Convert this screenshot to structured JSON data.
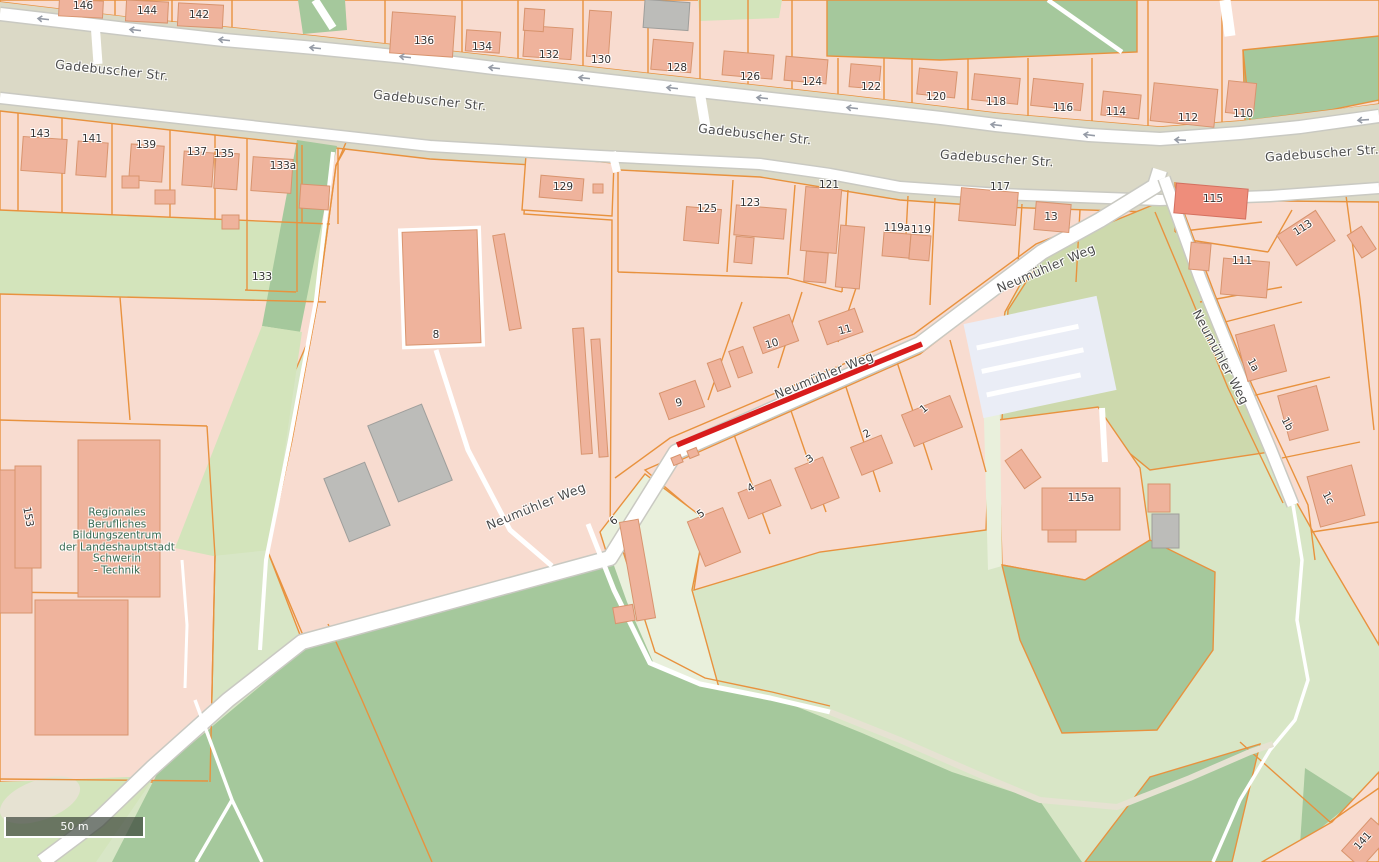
{
  "map": {
    "scale_bar": {
      "text": "50 m"
    },
    "colors": {
      "residential_pink": "#f8dcd0",
      "building_salmon": "#efb39c",
      "building_outline": "#d8946e",
      "building_highlight": "#ee8d7b",
      "building_grey": "#bcbcb9",
      "parcel_orange": "#e8923e",
      "road_yellow": "#f8e87c",
      "road_yellow_casing": "#d8c96e",
      "road_white": "#ffffff",
      "road_casing": "#c9c9c2",
      "road_area_tan": "#dbd9c6",
      "industrial_grey": "#e4e4e1",
      "parking_grey": "#eaedf6",
      "forest_green": "#a5c89c",
      "grass_green": "#d3e4bb",
      "meadow_green": "#d8e6c6",
      "pale_green": "#e9f0dc",
      "scrub_olive": "#cdd9ad",
      "path_beige": "#e6e2d2",
      "highlight_red": "#d81c1c",
      "arrow_grey": "#959ba6",
      "street_label": "#4c4c4c",
      "number_label": "#333333",
      "school_label": "#356b53",
      "scalebar_bg": "rgba(55,65,55,0.68)",
      "scalebar_text": "#ffffff"
    },
    "street_labels": [
      {
        "text": "Gadebuscher Str.",
        "x": 112,
        "y": 70,
        "rot": 6
      },
      {
        "text": "Gadebuscher Str.",
        "x": 430,
        "y": 100,
        "rot": 6
      },
      {
        "text": "Gadebuscher Str.",
        "x": 755,
        "y": 134,
        "rot": 6
      },
      {
        "text": "Gadebuscher Str.",
        "x": 997,
        "y": 158,
        "rot": 4
      },
      {
        "text": "Gadebuscher Str.",
        "x": 1322,
        "y": 153,
        "rot": -4
      },
      {
        "text": "Neumühler Weg",
        "x": 824,
        "y": 375,
        "rot": -22
      },
      {
        "text": "Neumühler Weg",
        "x": 1046,
        "y": 268,
        "rot": -23
      },
      {
        "text": "Neumühler Weg",
        "x": 1221,
        "y": 357,
        "rot": 62
      },
      {
        "text": "Neumühler Weg",
        "x": 536,
        "y": 506,
        "rot": -22
      }
    ],
    "house_numbers": [
      {
        "text": "146",
        "x": 83,
        "y": 6
      },
      {
        "text": "144",
        "x": 147,
        "y": 11
      },
      {
        "text": "142",
        "x": 199,
        "y": 15
      },
      {
        "text": "136",
        "x": 424,
        "y": 41
      },
      {
        "text": "134",
        "x": 482,
        "y": 47
      },
      {
        "text": "132",
        "x": 549,
        "y": 55
      },
      {
        "text": "130",
        "x": 601,
        "y": 60
      },
      {
        "text": "128",
        "x": 677,
        "y": 68
      },
      {
        "text": "126",
        "x": 750,
        "y": 77
      },
      {
        "text": "124",
        "x": 812,
        "y": 82
      },
      {
        "text": "122",
        "x": 871,
        "y": 87
      },
      {
        "text": "120",
        "x": 936,
        "y": 97
      },
      {
        "text": "118",
        "x": 996,
        "y": 102
      },
      {
        "text": "116",
        "x": 1063,
        "y": 108
      },
      {
        "text": "114",
        "x": 1116,
        "y": 112
      },
      {
        "text": "112",
        "x": 1188,
        "y": 118
      },
      {
        "text": "110",
        "x": 1243,
        "y": 114
      },
      {
        "text": "143",
        "x": 40,
        "y": 134
      },
      {
        "text": "141",
        "x": 92,
        "y": 139
      },
      {
        "text": "139",
        "x": 146,
        "y": 145
      },
      {
        "text": "137",
        "x": 197,
        "y": 152
      },
      {
        "text": "135",
        "x": 224,
        "y": 154
      },
      {
        "text": "133a",
        "x": 283,
        "y": 166
      },
      {
        "text": "133",
        "x": 262,
        "y": 277
      },
      {
        "text": "129",
        "x": 563,
        "y": 187
      },
      {
        "text": "125",
        "x": 707,
        "y": 209
      },
      {
        "text": "123",
        "x": 750,
        "y": 203
      },
      {
        "text": "121",
        "x": 829,
        "y": 185
      },
      {
        "text": "119a",
        "x": 897,
        "y": 228
      },
      {
        "text": "119",
        "x": 921,
        "y": 230
      },
      {
        "text": "117",
        "x": 1000,
        "y": 187
      },
      {
        "text": "13",
        "x": 1051,
        "y": 217
      },
      {
        "text": "115",
        "x": 1213,
        "y": 199
      },
      {
        "text": "111",
        "x": 1242,
        "y": 261
      },
      {
        "text": "113",
        "x": 1303,
        "y": 228,
        "rot": -33
      },
      {
        "text": "8",
        "x": 436,
        "y": 335
      },
      {
        "text": "10",
        "x": 772,
        "y": 344,
        "rot": -15
      },
      {
        "text": "11",
        "x": 845,
        "y": 330,
        "rot": -15
      },
      {
        "text": "9",
        "x": 679,
        "y": 403,
        "rot": -12
      },
      {
        "text": "1",
        "x": 924,
        "y": 409,
        "rot": -40
      },
      {
        "text": "2",
        "x": 867,
        "y": 434,
        "rot": -30
      },
      {
        "text": "3",
        "x": 810,
        "y": 459,
        "rot": -35
      },
      {
        "text": "4",
        "x": 751,
        "y": 488,
        "rot": -30
      },
      {
        "text": "5",
        "x": 701,
        "y": 514,
        "rot": -35
      },
      {
        "text": "6",
        "x": 614,
        "y": 521,
        "rot": -40
      },
      {
        "text": "115a",
        "x": 1081,
        "y": 498
      },
      {
        "text": "1a",
        "x": 1253,
        "y": 365,
        "rot": 62
      },
      {
        "text": "1b",
        "x": 1287,
        "y": 424,
        "rot": 62
      },
      {
        "text": "1c",
        "x": 1328,
        "y": 498,
        "rot": 62
      },
      {
        "text": "153",
        "x": 28,
        "y": 517,
        "rot": 80
      },
      {
        "text": "141",
        "x": 1363,
        "y": 841,
        "rot": -48
      }
    ],
    "school": {
      "x": 117,
      "y": 542,
      "lines": [
        "Regionales",
        "Berufliches",
        "Bildungszentrum",
        "der Landeshauptstadt",
        "Schwerin",
        "- Technik"
      ]
    },
    "oneway_arrows": [
      {
        "x": 43,
        "y": 19,
        "rot": 6
      },
      {
        "x": 135,
        "y": 30,
        "rot": 6
      },
      {
        "x": 224,
        "y": 40,
        "rot": 6
      },
      {
        "x": 315,
        "y": 48,
        "rot": 6
      },
      {
        "x": 405,
        "y": 57,
        "rot": 6
      },
      {
        "x": 494,
        "y": 68,
        "rot": 6
      },
      {
        "x": 584,
        "y": 78,
        "rot": 6
      },
      {
        "x": 672,
        "y": 88,
        "rot": 6
      },
      {
        "x": 762,
        "y": 98,
        "rot": 6
      },
      {
        "x": 852,
        "y": 108,
        "rot": 6
      },
      {
        "x": 996,
        "y": 125,
        "rot": 7
      },
      {
        "x": 1089,
        "y": 135,
        "rot": 7
      },
      {
        "x": 1180,
        "y": 140,
        "rot": 3
      },
      {
        "x": 1363,
        "y": 120,
        "rot": -4
      }
    ]
  }
}
